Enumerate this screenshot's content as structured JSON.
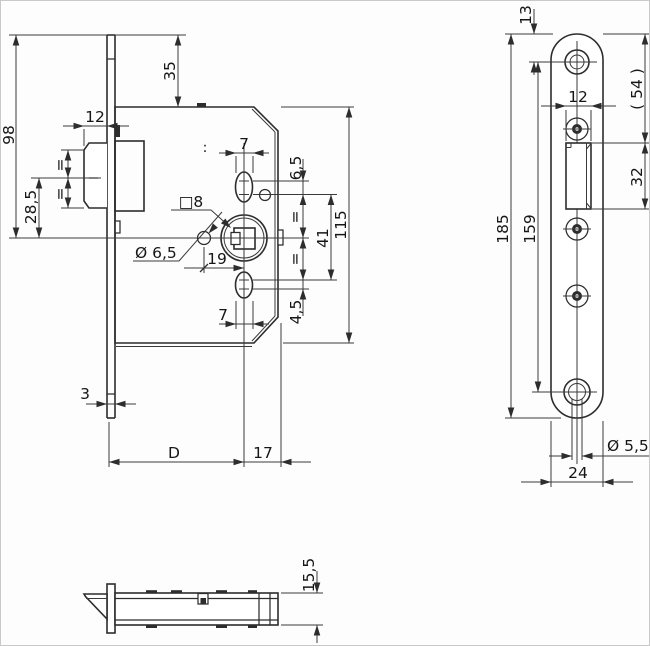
{
  "drawing": {
    "kind": "mortise-lock technical drawing, three orthographic views"
  },
  "front_view": {
    "dim_98": "98",
    "dim_35": "35",
    "dim_12": "12",
    "dim_28_5": "28,5",
    "equal_latch_top": "=",
    "equal_latch_bottom": "=",
    "dim_7_top": "7",
    "dim_6_5": "6,5",
    "square_8": "□8",
    "dia_6_5": "Ø 6,5",
    "dim_19": "19",
    "equal_right_top": "=",
    "equal_right_bottom": "=",
    "dim_41": "41",
    "dim_115": "115",
    "dim_4_5": "4,5",
    "dim_7_bottom": "7",
    "dim_3": "3",
    "dim_D": "D",
    "dim_17": "17",
    "rivet_marks": ":"
  },
  "face_plate_view": {
    "dim_13": "13",
    "dim_54_ref": "( 54 )",
    "dim_12": "12",
    "dim_32": "32",
    "dim_185": "185",
    "dim_159": "159",
    "dia_5_5": "Ø 5,5",
    "dim_24": "24"
  },
  "bottom_view": {
    "dim_15_5": "15,5"
  }
}
